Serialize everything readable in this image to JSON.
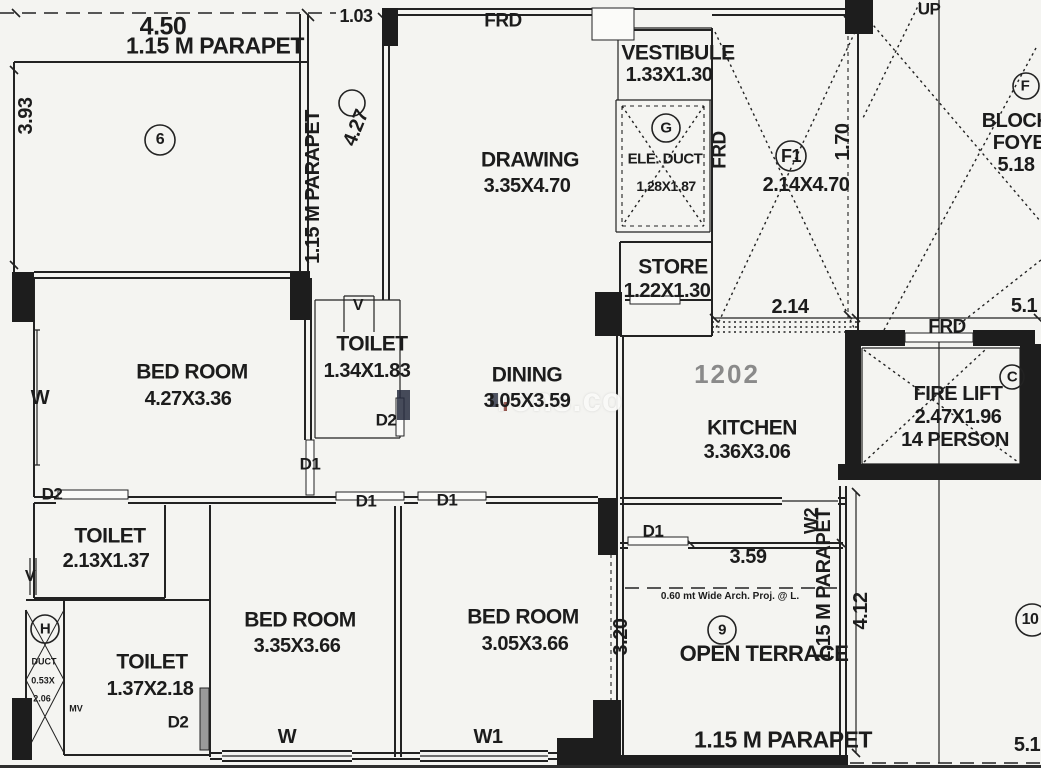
{
  "unit": {
    "number": "1202"
  },
  "rooms": {
    "drawing": {
      "name": "DRAWING",
      "dim": "3.35X4.70"
    },
    "vestibule": {
      "name": "VESTIBULE",
      "dim": "1.33X1.30"
    },
    "ele_duct": {
      "name": "ELE. DUCT",
      "dim": "1.28X1.87"
    },
    "store": {
      "name": "STORE",
      "dim": "1.22X1.30"
    },
    "kitchen": {
      "name": "KITCHEN",
      "dim": "3.36X3.06"
    },
    "dining": {
      "name": "DINING",
      "dim": "3.05X3.59"
    },
    "bed1": {
      "name": "BED ROOM",
      "dim": "4.27X3.36"
    },
    "bed2": {
      "name": "BED ROOM",
      "dim": "3.35X3.66"
    },
    "bed3": {
      "name": "BED ROOM",
      "dim": "3.05X3.66"
    },
    "toilet1": {
      "name": "TOILET",
      "dim": "1.34X1.83"
    },
    "toilet2": {
      "name": "TOILET",
      "dim": "2.13X1.37"
    },
    "toilet3": {
      "name": "TOILET",
      "dim": "1.37X2.18"
    },
    "firelift": {
      "name": "FIRE LIFT",
      "dim": "2.47X1.96",
      "capacity": "14 PERSON"
    },
    "f1lift": {
      "dim": "2.14X4.70"
    },
    "terrace": {
      "name": "OPEN TERRACE"
    },
    "duct_h": {
      "name": "DUCT",
      "dim_a": "0.53X",
      "dim_b": "2.06"
    }
  },
  "doors": {
    "d1": "D1",
    "d2": "D2",
    "frd": "FRD"
  },
  "windows": {
    "w": "W",
    "w1": "W1",
    "w2": "W2",
    "v": "V",
    "mv": "MV"
  },
  "refs": {
    "six": "6",
    "nine": "9",
    "ten": "10",
    "g": "G",
    "h": "H",
    "f": "F",
    "c": "C",
    "f1": "F1"
  },
  "dims": {
    "d450": "4.50",
    "d103": "1.03",
    "d393": "3.93",
    "d427": "4.27",
    "d170": "1.70",
    "d214": "2.14",
    "d51": "5.1",
    "d359": "3.59",
    "d412": "4.12",
    "d320": "3.20",
    "d518": "5.18",
    "parapet": "1.15 M PARAPET",
    "arch_proj": "0.60 mt Wide Arch. Proj. @ L.",
    "up": "UP"
  },
  "foyer": {
    "line1": "BLOCK",
    "line2": "FOYER"
  },
  "watermark": {
    "text": "rons.co",
    "accent_colors": [
      "#262c3e",
      "#7a2a22"
    ]
  },
  "colors": {
    "line": "#222222",
    "paper": "#f4f4f1",
    "unit_number": "#8a8a8a"
  }
}
